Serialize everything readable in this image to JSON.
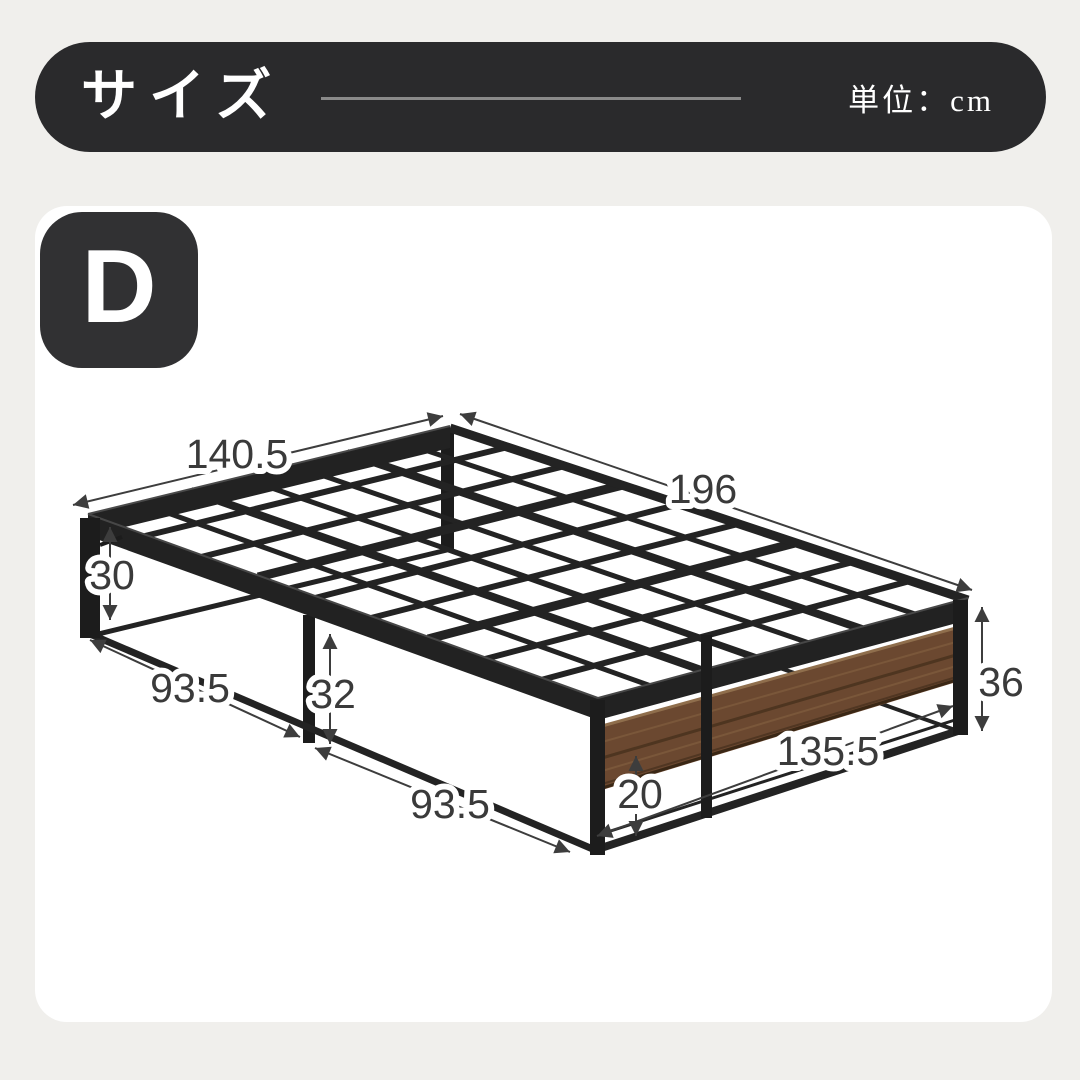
{
  "header": {
    "title": "サイズ",
    "unit_label": "単位：cm"
  },
  "size_badge": {
    "label": "D"
  },
  "diagram": {
    "product": "platform-bed-frame",
    "unit": "cm",
    "dimensions": {
      "top_width": "140.5",
      "top_length": "196",
      "left_leg_height": "30",
      "front_half_1": "93.5",
      "center_leg_height": "32",
      "front_half_2": "93.5",
      "foot_inner_width": "135.5",
      "panel_to_rail_gap": "20",
      "foot_end_height": "36"
    },
    "colors": {
      "metal": "#232323",
      "wood": "#6b4830",
      "dimension_lines": "#3d3d3d",
      "banner": "#2a2a2c",
      "background": "#f0efec"
    }
  }
}
